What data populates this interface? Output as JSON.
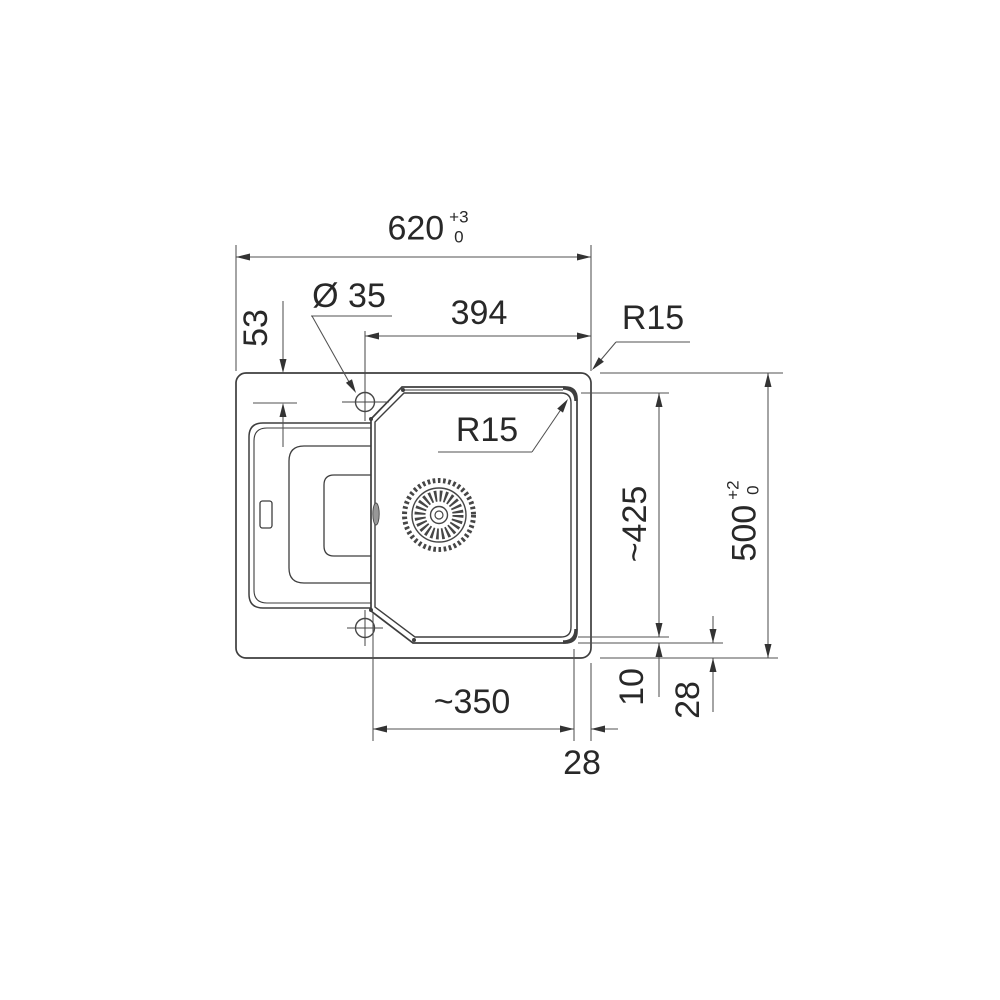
{
  "colors": {
    "outline": "#3e3e3e",
    "dimension_lines": "#515151",
    "text": "#282828",
    "background": "#ffffff"
  },
  "labels": {
    "overall_width": "620",
    "overall_width_tol_upper": "+3",
    "overall_width_tol_lower": "0",
    "faucet_diameter": "Ø 35",
    "bowl_top_width": "394",
    "faucet_center_from_top": "53",
    "outer_corner_radius": "R15",
    "bowl_corner_radius": "R15",
    "bowl_length": "~425",
    "overall_depth": "500",
    "overall_depth_tol_upper": "+2",
    "overall_depth_tol_lower": "0",
    "rim_width": "10",
    "rim_to_edge_bottom": "28",
    "bowl_bottom_width": "~350",
    "bowl_to_edge_right": "28"
  }
}
